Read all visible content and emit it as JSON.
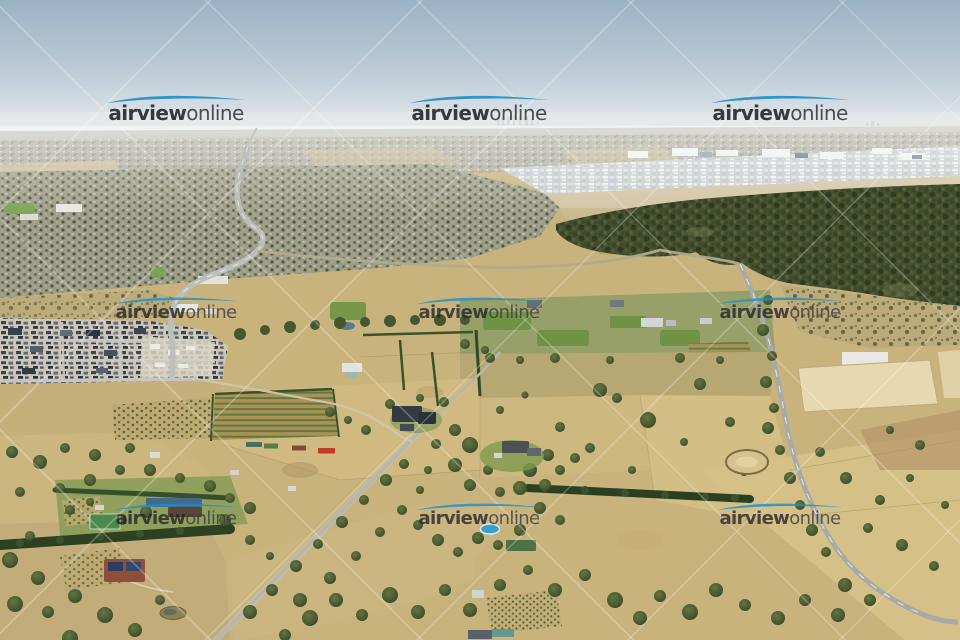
{
  "image": {
    "kind": "watermarked stock aerial photograph",
    "description": "Oblique aerial view over dry semi-rural acreage on a city fringe: golden paddocks, tree-lined rural roads, hedgerows, an orchard, hobby farms with pools and tennis courts, a new housing estate at lower left, dark bushland in the middle distance, industrial sheds and dense suburbs stretching to a hazy pale-blue horizon with a faint city skyline."
  },
  "watermark": {
    "brand_bold": "airview",
    "brand_light": "online",
    "repeat_grid": {
      "columns": 3,
      "rows": 3
    },
    "column_centers_x": [
      176,
      479,
      780
    ],
    "row_tops_y": [
      93,
      295,
      501
    ]
  },
  "theme": {
    "wm_swoosh": "#1e8fc9",
    "wm_text_bold": "#26252c",
    "wm_text_light": "#3c3b42",
    "sky_top": "#9bb2c6",
    "haze": "#e9eceb",
    "dry_grass": "#c8b37d",
    "forest_green": "#46502e",
    "road_grey": "#a8aaa5"
  }
}
